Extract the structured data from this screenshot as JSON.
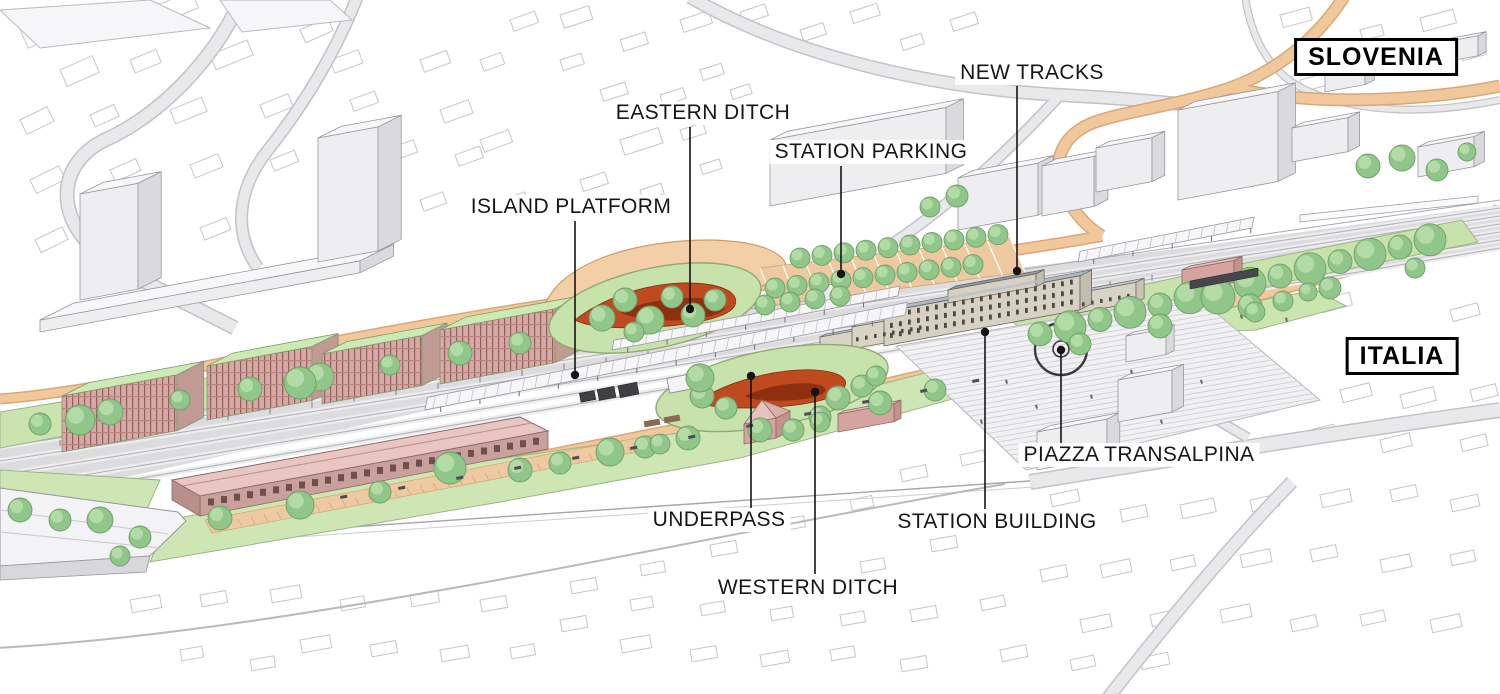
{
  "country_labels": [
    {
      "text": "SLOVENIA"
    },
    {
      "text": "ITALIA"
    }
  ],
  "annotations": [
    {
      "text": "ISLAND PLATFORM"
    },
    {
      "text": "EASTERN DITCH"
    },
    {
      "text": "STATION PARKING"
    },
    {
      "text": "NEW TRACKS"
    },
    {
      "text": "PIAZZA TRANSALPINA"
    },
    {
      "text": "UNDERPASS"
    },
    {
      "text": "STATION BUILDING"
    },
    {
      "text": "WESTERN DITCH"
    }
  ],
  "colors": {
    "ditch_red": "#c04a20",
    "ditch_red_dark": "#8e2f10",
    "tree_green": "#90c689",
    "lawn_green": "#cbe4af",
    "road_orange": "#f1c79c",
    "station_roof_blue_gray": "#98a4b0",
    "new_building_roof_green": "#cdeab5",
    "new_building_facade_pink": "#d8a9a4",
    "historic_building_pink": "#e9c6c1",
    "context_gray": "#e9e9ec"
  }
}
